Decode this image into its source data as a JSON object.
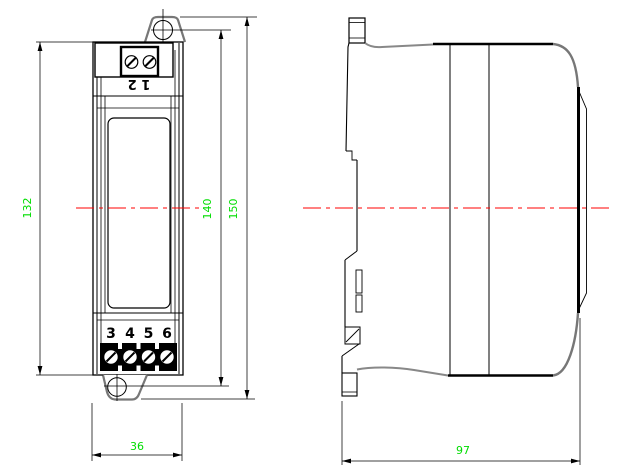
{
  "front_view": {
    "top_terminal_label": "1 2",
    "bottom_terminal_labels": [
      "3",
      "4",
      "5",
      "6"
    ]
  },
  "dimensions": {
    "body_height": "132",
    "hole_spacing": "140",
    "overall_height": "150",
    "width": "36",
    "depth": "97"
  },
  "colors": {
    "dimension_text": "#00dd00",
    "centerline": "#ff0000",
    "outline": "#000000"
  }
}
